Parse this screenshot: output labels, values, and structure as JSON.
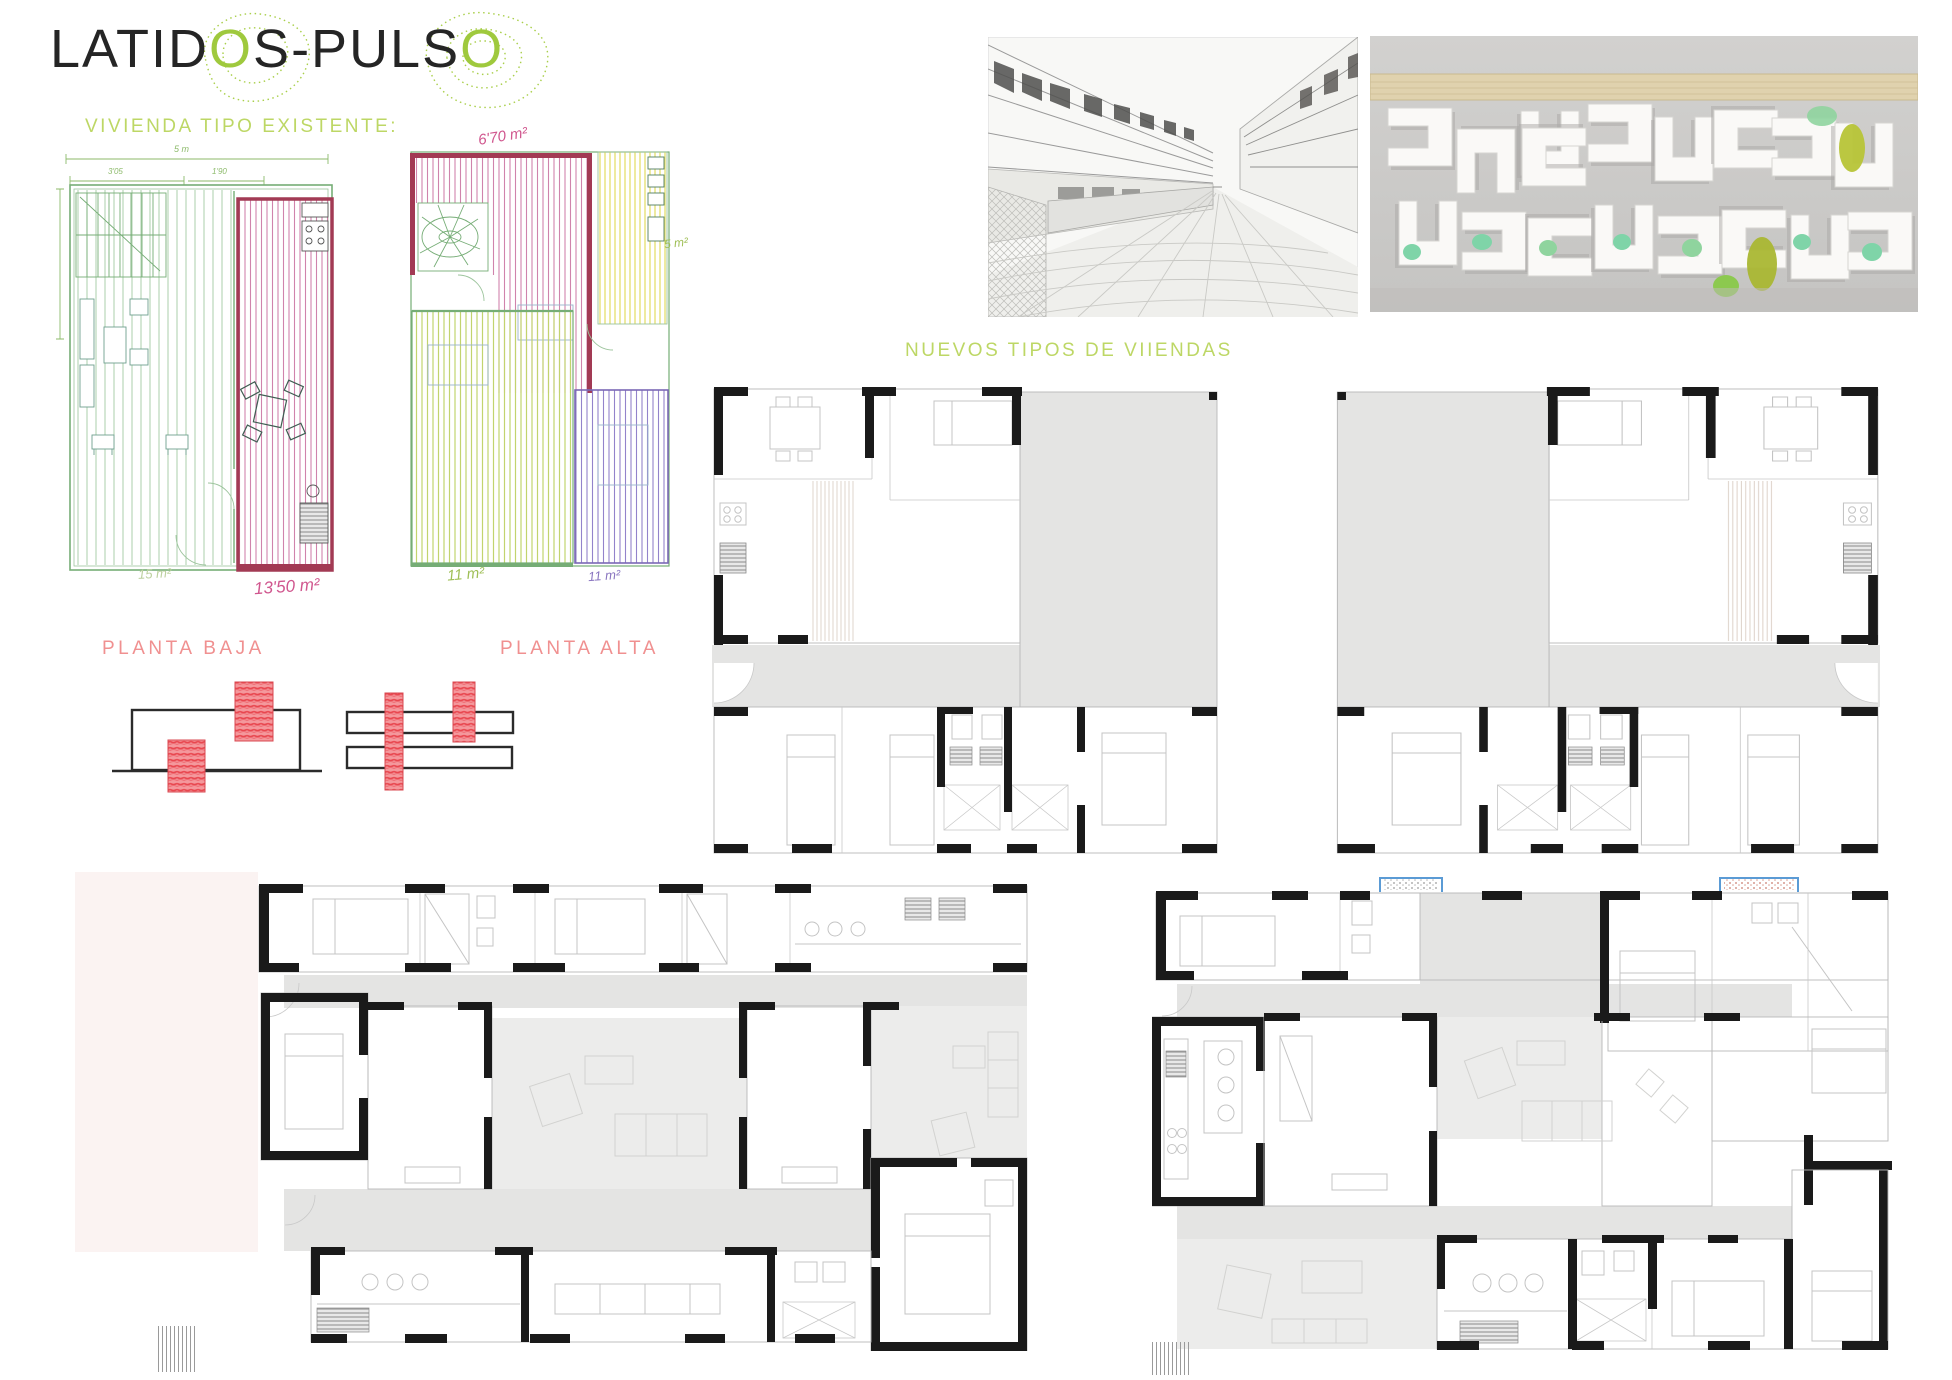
{
  "header": {
    "title_full": "LATIDOS-PULSO",
    "title_p1": "LATID",
    "title_o1": "O",
    "title_p2": "S-PULS",
    "title_o2": "O"
  },
  "section_labels": {
    "existing": "VIVIENDA TIPO EXISTENTE:",
    "new_types": "NUEVOS TIPOS DE VIIENDAS",
    "planta_baja": "PLANTA BAJA",
    "planta_alta": "PLANTA ALTA"
  },
  "sketch_annotations": {
    "alta_total_area": "6'70 m²",
    "baja_room_area": "13'50 m²",
    "baja_living_area": "15 m²",
    "alta_room_green_area": "11 m²",
    "alta_room_purple_area": "11 m²",
    "alta_bath_area": "5 m²",
    "dim_width": "5 m",
    "dim_a": "3'05",
    "dim_b": "1'90"
  },
  "photos": {
    "street": {
      "name": "street-perspective-sketch-photo"
    },
    "model": {
      "name": "white-foam-massing-model-photo"
    }
  },
  "colors": {
    "accent_green": "#b5d44c",
    "title_green": "#9fc93d",
    "label_salmon": "#f09090",
    "sketch_pink": "#cd7aa4",
    "sketch_crimson": "#a23a54",
    "sketch_green": "#76ad76",
    "sketch_yellow": "#ddd75a",
    "sketch_lime": "#c2d46e",
    "sketch_purple": "#9383cb",
    "diagram_red": "#e8474f",
    "plan_black": "#1a1a1a",
    "plan_gray": "#e4e4e3",
    "skylight_blue": "#5b9bd5"
  }
}
